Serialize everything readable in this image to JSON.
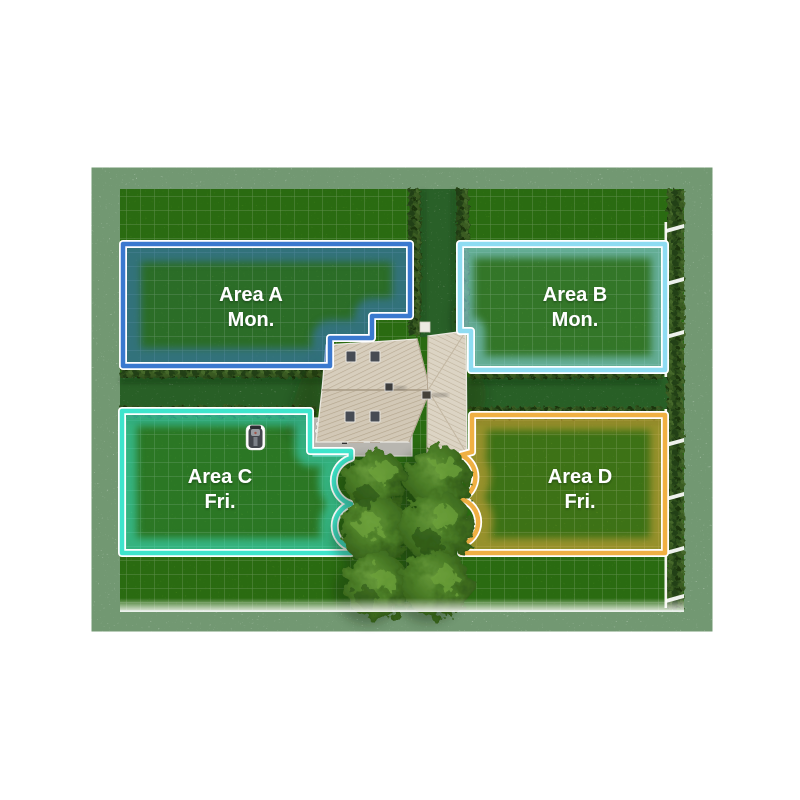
{
  "page": {
    "background_color": "#ffffff"
  },
  "map": {
    "description_labels": {
      "zone_a_name": "Area A",
      "zone_a_day": "Mon.",
      "zone_b_name": "Area B",
      "zone_b_day": "Mon.",
      "zone_c_name": "Area C",
      "zone_c_day": "Fri.",
      "zone_d_name": "Area D",
      "zone_d_day": "Fri."
    },
    "zones": [
      {
        "id": "zone-a",
        "label": "Area A",
        "schedule_day": "Mon.",
        "accent_color": "#3a79cf"
      },
      {
        "id": "zone-b",
        "label": "Area B",
        "schedule_day": "Mon.",
        "accent_color": "#8edcf2"
      },
      {
        "id": "zone-c",
        "label": "Area C",
        "schedule_day": "Fri.",
        "accent_color": "#3ee5cc"
      },
      {
        "id": "zone-d",
        "label": "Area D",
        "schedule_day": "Fri.",
        "accent_color": "#f0b043"
      }
    ],
    "icons": {
      "robot_mower": "robot-mower-icon"
    },
    "colors": {
      "grass": "#5f9a26",
      "gravel_path": "#cdccc6",
      "hedge": "#2f4f1b",
      "roof": "#d6cdbc",
      "tree": "#3c6b1e"
    }
  }
}
